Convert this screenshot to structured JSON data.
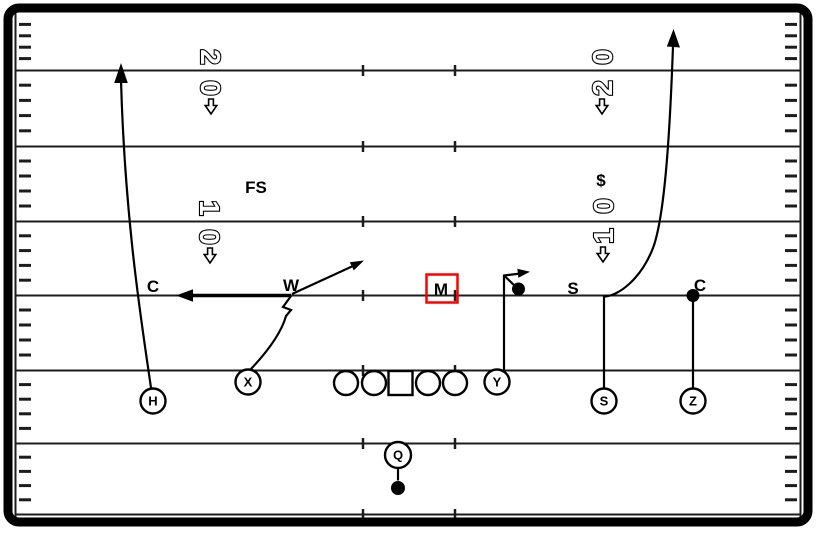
{
  "colors": {
    "ink": "#000000",
    "line": "#1c1c1c",
    "highlight": "#fa0000",
    "bg": "#ffffff"
  },
  "defense": {
    "fs": "FS",
    "corner_left": "C",
    "will": "W",
    "mike": "M",
    "sam": "S",
    "corner_right": "C",
    "money": "$"
  },
  "offense": {
    "h": "H",
    "x": "X",
    "y": "Y",
    "s": "S",
    "z": "Z",
    "q": "Q"
  },
  "yard_numbers": {
    "left_20": {
      "top": "2",
      "bottom": "0"
    },
    "left_10": {
      "top": "1",
      "bottom": "0"
    },
    "right_20": {
      "top": "0",
      "bottom": "2"
    },
    "right_10": {
      "top": "0",
      "bottom": "1"
    }
  }
}
